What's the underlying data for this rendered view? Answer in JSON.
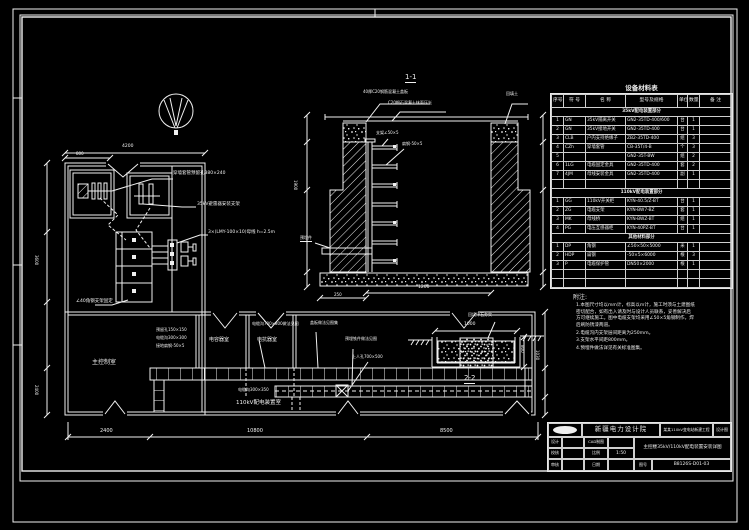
{
  "colors": {
    "background": "#000000",
    "line": "#f0f0f0"
  },
  "sheet": {
    "institute": "新疆电力设计院",
    "project": "某某110kV变电站新建工程",
    "stage": "设计图",
    "drawing_title": "主控楼35kV/110kV配电装置安装详图",
    "fields": {
      "design": "设计",
      "cad": "CAD制图",
      "check": "校核",
      "review": "审核",
      "scale_label": "比例",
      "scale": "1:50",
      "date_label": "日期",
      "date": "",
      "dwg_no_label": "图号",
      "dwg_no": "B8126S-D01-03"
    }
  },
  "table": {
    "title": "设备材料表",
    "headers": [
      "序号",
      "符 号",
      "名    称",
      "型号及规格",
      "单位",
      "数量",
      "备  注"
    ],
    "col_widths": [
      12,
      22,
      40,
      52,
      10,
      12,
      32
    ],
    "sections": [
      {
        "band": "35kV配电装置部分",
        "blanks_after": 1,
        "rows": [
          [
            "1",
            "GN",
            "35kV隔离开关",
            "GN2-35TD-400/600",
            "台",
            "1",
            ""
          ],
          [
            "2",
            "GN",
            "35kV接地开关",
            "GN2-35TD-400",
            "台",
            "1",
            ""
          ],
          [
            "3",
            "CLB",
            "户内支持绝缘子",
            "ZB2-35TD-400",
            "组",
            "3",
            ""
          ],
          [
            "4",
            "CZh",
            "穿墙套管",
            "CB-35T/4-B",
            "个",
            "3",
            ""
          ],
          [
            "5",
            "",
            "",
            "GN2-35T-BW",
            "组",
            "2",
            ""
          ],
          [
            "6",
            "1LG",
            "电缆固定金具",
            "GN2-35TD-400",
            "套",
            "2",
            ""
          ],
          [
            "7",
            "4JM",
            "母线安装金具",
            "GN2-35TD-400",
            "副",
            "1",
            ""
          ]
        ]
      },
      {
        "band": "110kV配电装置部分",
        "blanks_after": 0,
        "rows": [
          [
            "1",
            "GG",
            "110kV开关柜",
            "KYN-40.5/Z-BT",
            "台",
            "1",
            ""
          ],
          [
            "2",
            "ZG",
            "电缆支架",
            "KYN-BW7-BZ",
            "套",
            "1",
            ""
          ],
          [
            "3",
            "MK",
            "母线桥",
            "KYN-BWZ-BT",
            "组",
            "1",
            ""
          ],
          [
            "4",
            "PG",
            "电压互感器柜",
            "KYN-40PZ-BT",
            "台",
            "1",
            ""
          ]
        ]
      },
      {
        "band": "其他材料部分",
        "blanks_after": 2,
        "rows": [
          [
            "1",
            "DP",
            "角钢",
            "∠50×50×5000",
            "米",
            "1",
            ""
          ],
          [
            "2",
            "HDP",
            "扁钢",
            "-50×5×6000",
            "根",
            "3",
            ""
          ],
          [
            "3",
            "P",
            "电缆保护管",
            "DN50×2000",
            "根",
            "1",
            ""
          ]
        ]
      }
    ]
  },
  "notes": {
    "title": "附注:",
    "items": [
      "1.本图尺寸均以mm计，标高以m计，施工时须与土建图纸密切配合，如有出入请及时与设计人员联系，妥善解决后方可继续施工。图中电缆支架均采用∠50×5角钢制作，焊后刷防锈漆两道。",
      "2.电缆沟内支架层间距离为250mm。",
      "3.支架水平间距800mm。",
      "4.预埋件做法详见有关标准图集。"
    ]
  },
  "labels": [
    {
      "x": 173,
      "y": 172,
      "t": "穿墙套管预留孔380×240",
      "fs": 4.5
    },
    {
      "x": 197,
      "y": 203,
      "t": "35kV避雷器安装支架",
      "fs": 4.5
    },
    {
      "x": 208,
      "y": 231,
      "t": "3×(LMY-100×10)母线 h=2.5m",
      "fs": 4.5
    },
    {
      "x": 76,
      "y": 300,
      "t": "∠40角钢支架固定",
      "fs": 4.5
    },
    {
      "x": 92,
      "y": 360,
      "t": "主控制室",
      "fs": 6
    },
    {
      "x": 209,
      "y": 338,
      "t": "电容器室",
      "fs": 5
    },
    {
      "x": 257,
      "y": 338,
      "t": "电抗器室",
      "fs": 5
    },
    {
      "x": 236,
      "y": 401,
      "t": "110kV配电装置室",
      "fs": 5.5
    },
    {
      "x": 238,
      "y": 388,
      "t": "电缆沟300×350",
      "fs": 4
    },
    {
      "x": 252,
      "y": 322,
      "t": "电缆沟700×800做法见图",
      "fs": 4
    },
    {
      "x": 310,
      "y": 321,
      "t": "盖板做法见图集",
      "fs": 4
    },
    {
      "x": 345,
      "y": 337,
      "t": "预埋铁件做法见图",
      "fs": 4
    },
    {
      "x": 352,
      "y": 355,
      "t": "上人孔700×500",
      "fs": 4
    },
    {
      "x": 156,
      "y": 328,
      "t": "预留孔150×150",
      "fs": 4
    },
    {
      "x": 156,
      "y": 336,
      "t": "电缆沟300×300",
      "fs": 4
    },
    {
      "x": 156,
      "y": 344,
      "t": "接地扁钢-50×5",
      "fs": 4
    },
    {
      "x": 100,
      "y": 429,
      "t": "2400",
      "fs": 5
    },
    {
      "x": 247,
      "y": 429,
      "t": "10800",
      "fs": 5
    },
    {
      "x": 440,
      "y": 429,
      "t": "8500",
      "fs": 5
    },
    {
      "x": 122,
      "y": 145,
      "t": "4200",
      "fs": 4.5
    },
    {
      "x": 76,
      "y": 152,
      "t": "800",
      "fs": 4
    },
    {
      "x": 38,
      "y": 255,
      "t": "3600",
      "fs": 4,
      "rot": 90
    },
    {
      "x": 38,
      "y": 385,
      "t": "2400",
      "fs": 4,
      "rot": 90
    },
    {
      "x": 539,
      "y": 350,
      "t": "1030",
      "fs": 4,
      "rot": 90
    },
    {
      "x": 405,
      "y": 74,
      "t": "1-1",
      "fs": 7,
      "u": true
    },
    {
      "x": 363,
      "y": 90,
      "t": "40厚C20钢筋混凝土盖板",
      "fs": 4
    },
    {
      "x": 388,
      "y": 101,
      "t": "C20细石混凝土抹面压光",
      "fs": 4
    },
    {
      "x": 506,
      "y": 92,
      "t": "回填土",
      "fs": 4
    },
    {
      "x": 376,
      "y": 131,
      "t": "支架∠50×5",
      "fs": 4
    },
    {
      "x": 402,
      "y": 142,
      "t": "扁钢-50×5",
      "fs": 4
    },
    {
      "x": 300,
      "y": 236,
      "t": "预埋件",
      "fs": 4,
      "u": true
    },
    {
      "x": 418,
      "y": 286,
      "t": "1200",
      "fs": 4.5
    },
    {
      "x": 334,
      "y": 293,
      "t": "250",
      "fs": 4
    },
    {
      "x": 297,
      "y": 180,
      "t": "1900",
      "fs": 4,
      "rot": 90
    },
    {
      "x": 468,
      "y": 313,
      "t": "回填碎石夯实",
      "fs": 4
    },
    {
      "x": 464,
      "y": 323,
      "t": "1000",
      "fs": 4.5
    },
    {
      "x": 524,
      "y": 345,
      "t": "800",
      "fs": 4,
      "rot": 90
    },
    {
      "x": 464,
      "y": 375,
      "t": "2-2",
      "fs": 7,
      "u": true
    }
  ]
}
